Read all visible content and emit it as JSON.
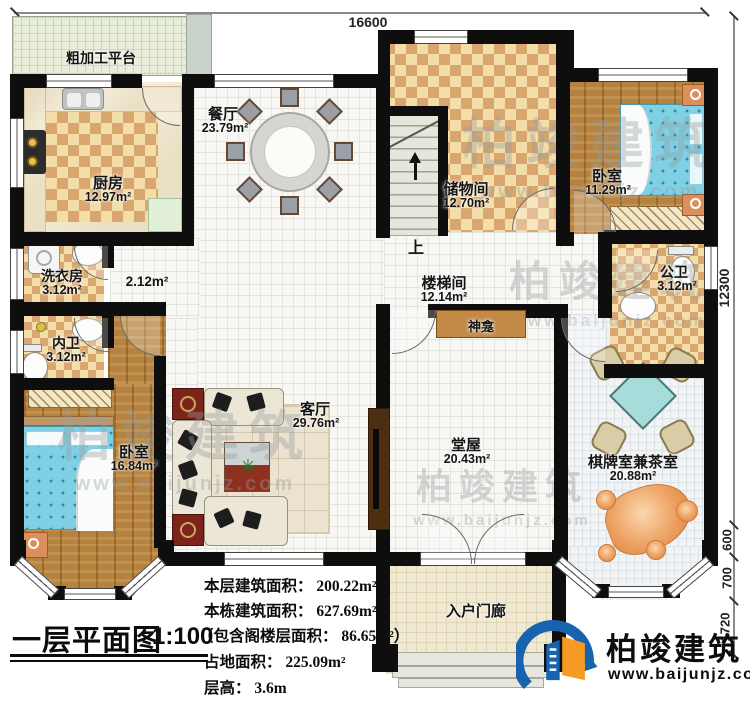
{
  "title": {
    "name": "一层平面图",
    "scale": "1:100"
  },
  "rooms": {
    "platform": {
      "label": "粗加工平台"
    },
    "kitchen": {
      "label": "厨房",
      "area": "12.97m²"
    },
    "dining": {
      "label": "餐厅",
      "area": "23.79m²"
    },
    "storage": {
      "label": "储物间",
      "area": "12.70m²"
    },
    "bedroom_top_right": {
      "label": "卧室",
      "area": "11.29m²"
    },
    "laundry": {
      "label": "洗衣房",
      "area": "3.12m²"
    },
    "hallway": {
      "area": "2.12m²"
    },
    "inner_bath": {
      "label": "内卫",
      "area": "3.12m²"
    },
    "bedroom_left": {
      "label": "卧室",
      "area": "16.84m²"
    },
    "living": {
      "label": "客厅",
      "area": "29.76m²"
    },
    "stairwell": {
      "label": "楼梯间",
      "area": "12.14m²"
    },
    "stairs_up": {
      "label": "上"
    },
    "public_bath": {
      "label": "公卫",
      "area": "3.12m²"
    },
    "shrine": {
      "label": "神龛"
    },
    "hall": {
      "label": "堂屋",
      "area": "20.43m²"
    },
    "chess_tea": {
      "label": "棋牌室兼茶室",
      "area": "20.88m²"
    },
    "porch": {
      "label": "入户门廊"
    }
  },
  "dimensions": {
    "top": "16600",
    "right": "12300",
    "seg_600": "600",
    "seg_700": "700",
    "seg_1720": "1720"
  },
  "stats": [
    "本层建筑面积： 200.22m²",
    "本栋建筑面积： 627.69m²",
    "（包含阁楼层面积： 86.65m²）",
    "占地面积： 225.09m²",
    "层高： 3.6m"
  ],
  "logo": {
    "name": "柏竣建筑",
    "url": "www.baijunjz.com"
  },
  "watermark": {
    "text": "柏竣建筑",
    "url": "www.baijunjz.com"
  },
  "colors": {
    "wall": "#0e0e0e",
    "checker_dark": "#d9a670",
    "checker_light": "#f3dda8",
    "wood_floor": "#b5823f",
    "bed_blue": "#7fd0e4",
    "mahjong_table": "#a6dcda",
    "logo_blue": "#1763ae",
    "logo_orange": "#f59a23",
    "shrine_brown": "#c28a46"
  }
}
